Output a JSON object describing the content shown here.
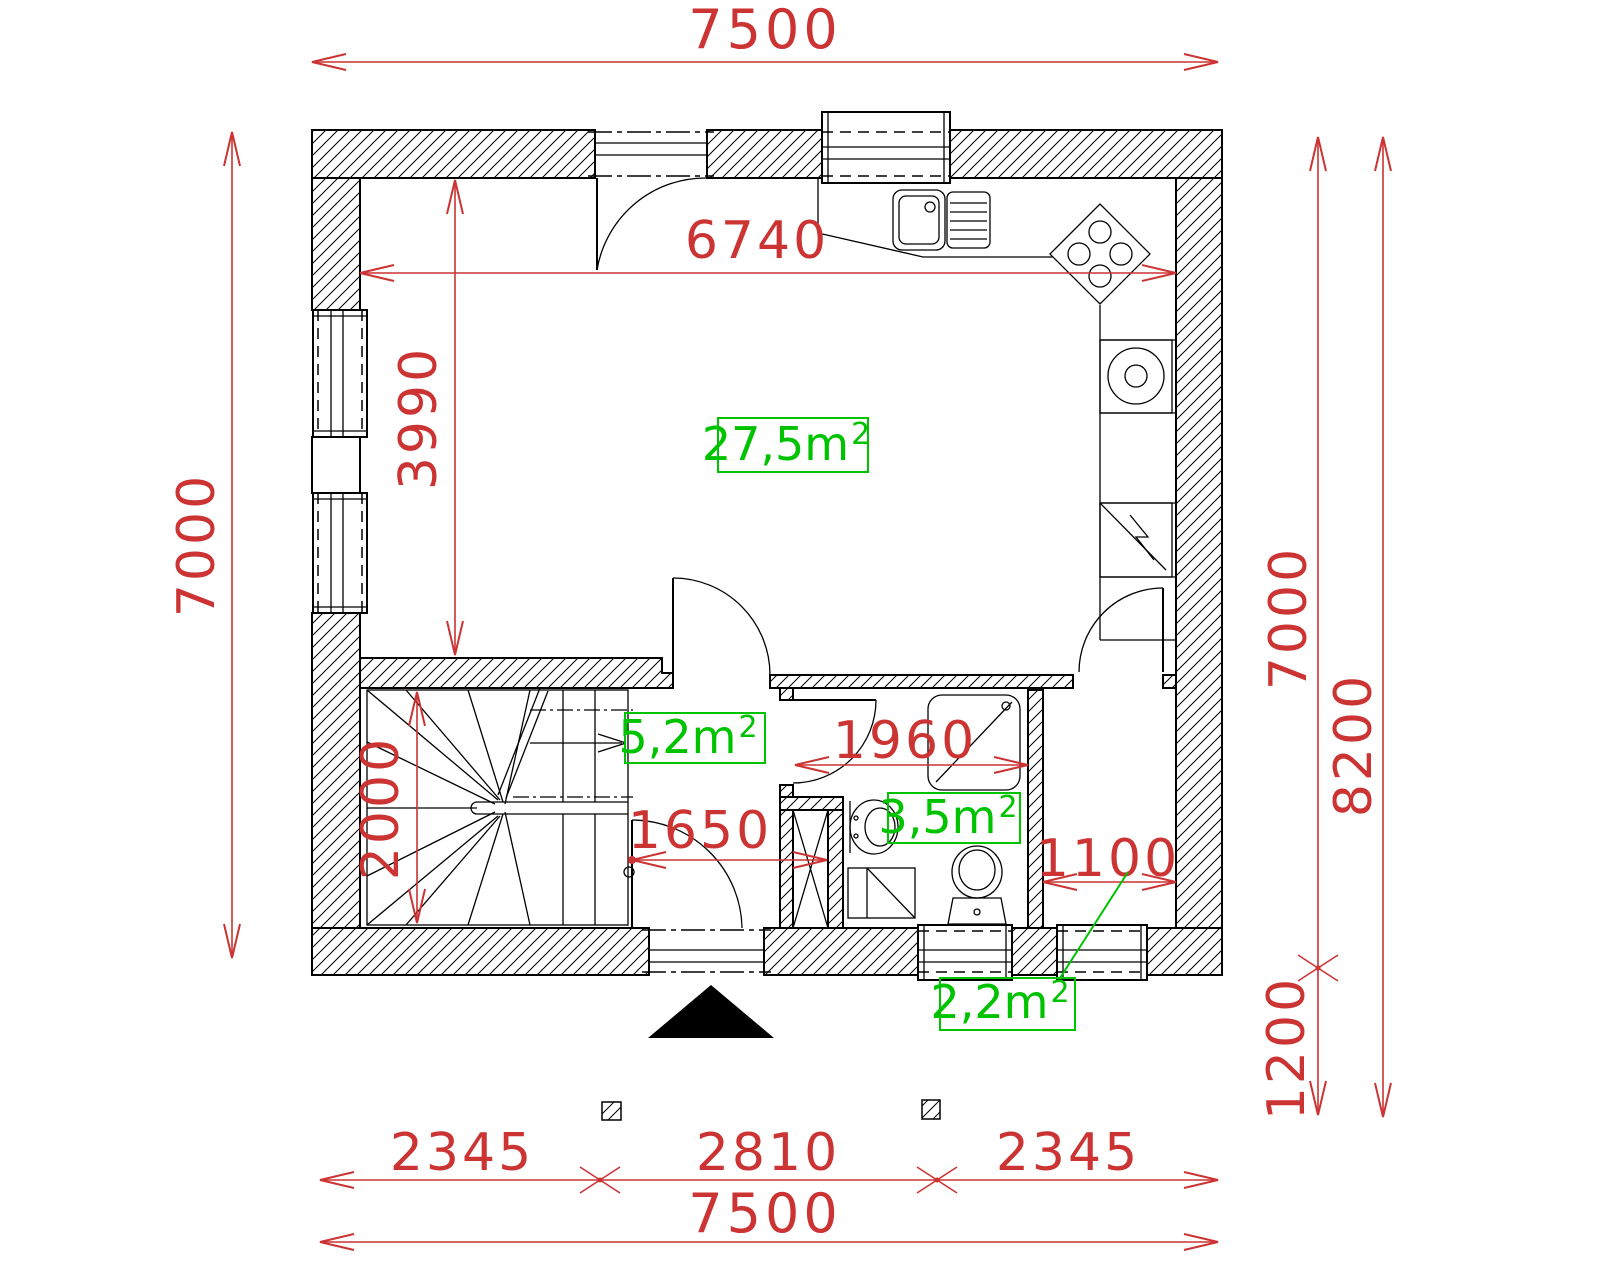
{
  "colors": {
    "dimension_text": "#cc3333",
    "area_label": "#00c300",
    "drawing": "#000000",
    "background": "#ffffff"
  },
  "dimensions": {
    "top_total": "7500",
    "top_inner": "6740",
    "left_total": "7000",
    "living_height": "3990",
    "stair_depth": "2000",
    "hall_width": "1650",
    "bath_width": "1960",
    "entry_width": "1100",
    "right_total": "7000",
    "overall_height": "8200",
    "porch_depth": "1200",
    "bottom_left": "2345",
    "bottom_center": "2810",
    "bottom_right": "2345",
    "bottom_total": "7500"
  },
  "areas": {
    "living": {
      "base": "27,5m",
      "sup": "2"
    },
    "hall": {
      "base": "5,2m",
      "sup": "2"
    },
    "bathroom": {
      "base": "3,5m",
      "sup": "2"
    },
    "entry": {
      "base": "2,2m",
      "sup": "2"
    }
  }
}
